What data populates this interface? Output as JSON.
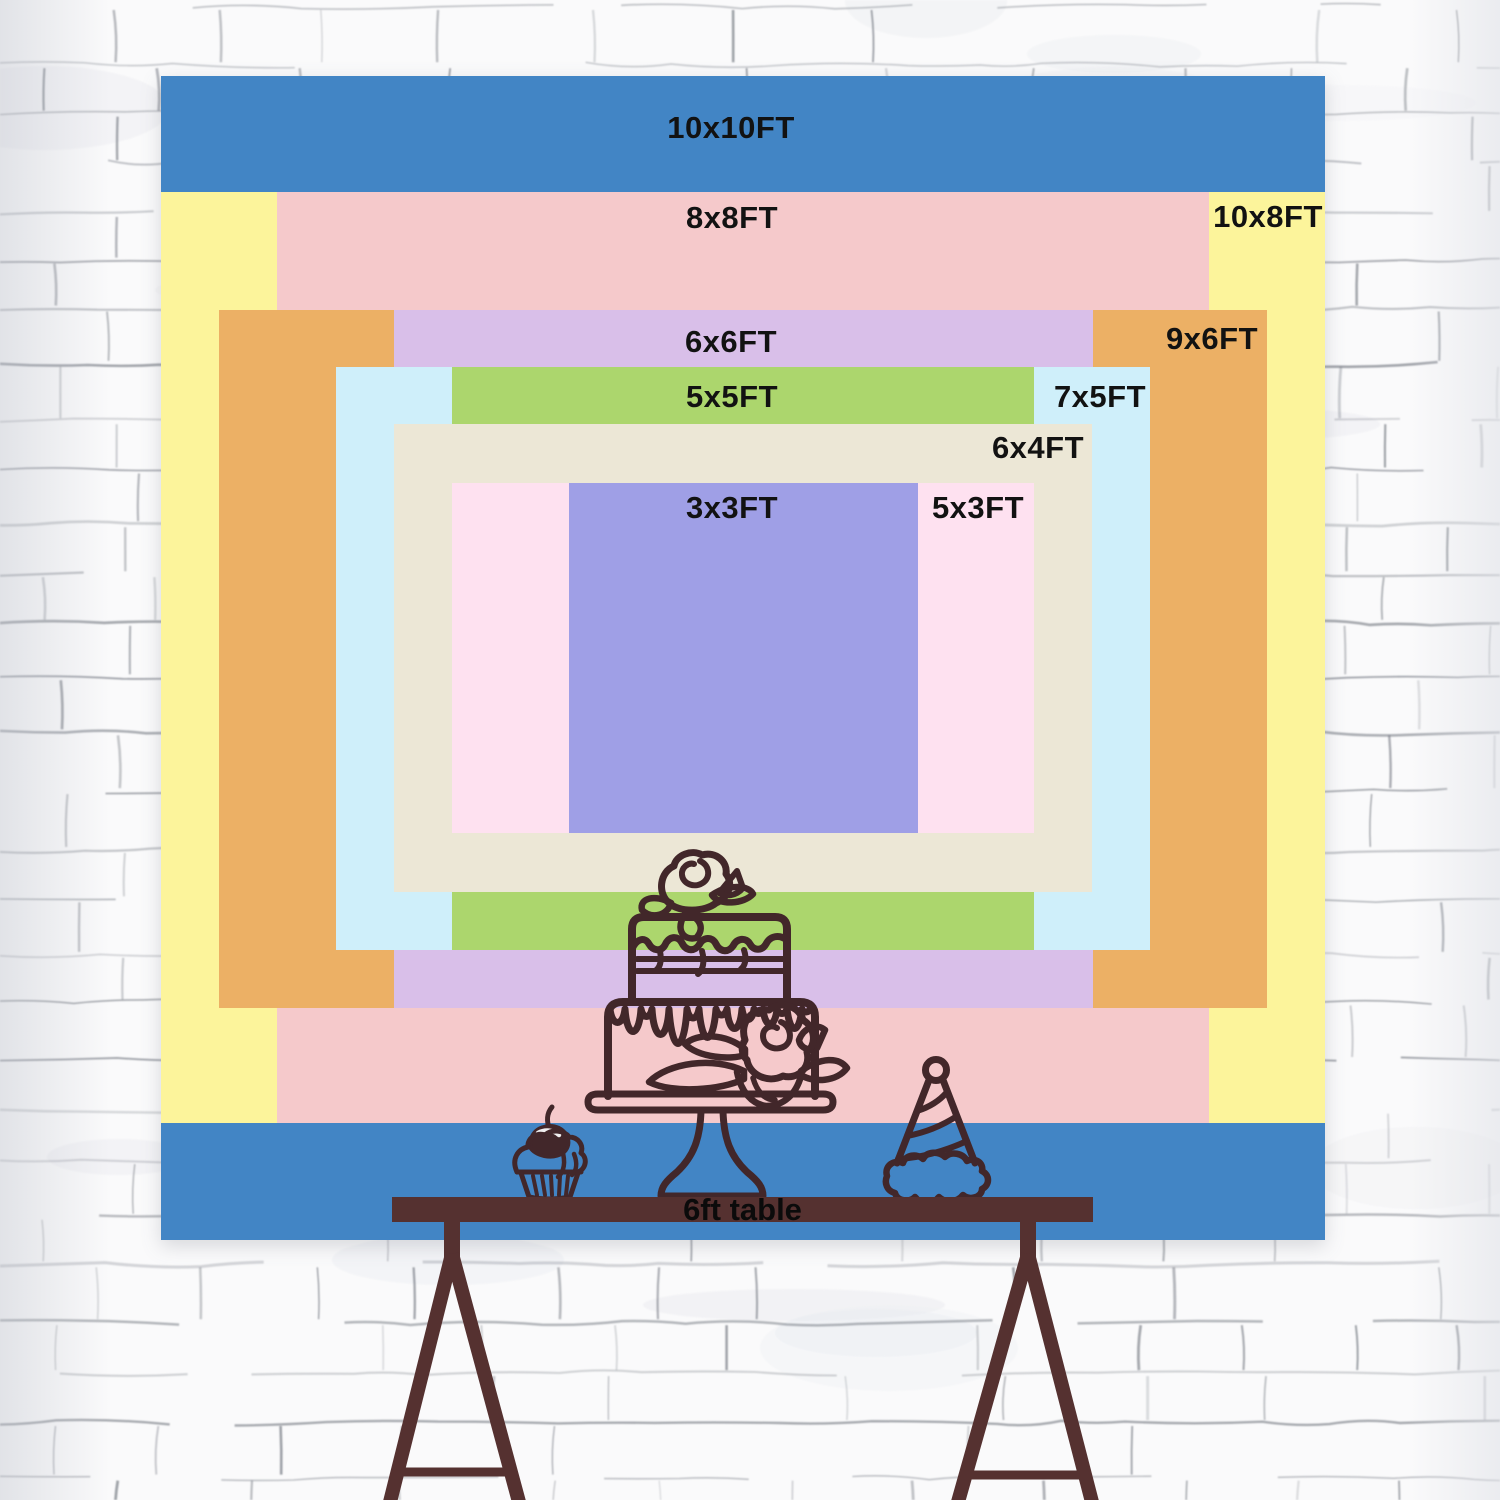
{
  "backdrop": {
    "description": "nested backdrop size chart",
    "sizes": [
      {
        "id": "10x10",
        "label": "10x10FT",
        "color": "#4285c5"
      },
      {
        "id": "10x8",
        "label": "10x8FT",
        "color": "#fcf49b"
      },
      {
        "id": "8x8",
        "label": "8x8FT",
        "color": "#f5c9cb"
      },
      {
        "id": "9x6",
        "label": "9x6FT",
        "color": "#ecb065"
      },
      {
        "id": "6x6",
        "label": "6x6FT",
        "color": "#d9bfe9"
      },
      {
        "id": "7x5",
        "label": "7x5FT",
        "color": "#cfeffa"
      },
      {
        "id": "5x5",
        "label": "5x5FT",
        "color": "#acd66d"
      },
      {
        "id": "6x4",
        "label": "6x4FT",
        "color": "#ece7d6"
      },
      {
        "id": "5x3",
        "label": "5x3FT",
        "color": "#fee1f0"
      },
      {
        "id": "3x3",
        "label": "3x3FT",
        "color": "#9f9fe6"
      }
    ]
  },
  "table": {
    "label": "6ft table",
    "color": "#553130"
  },
  "artwork": {
    "ink_color": "#42272a",
    "items": [
      "tiered-cake-icon",
      "cupcake-icon",
      "party-hat-icon"
    ]
  },
  "wall": {
    "base_color": "#fafafb",
    "mortar_line_color": "#6e737c"
  }
}
